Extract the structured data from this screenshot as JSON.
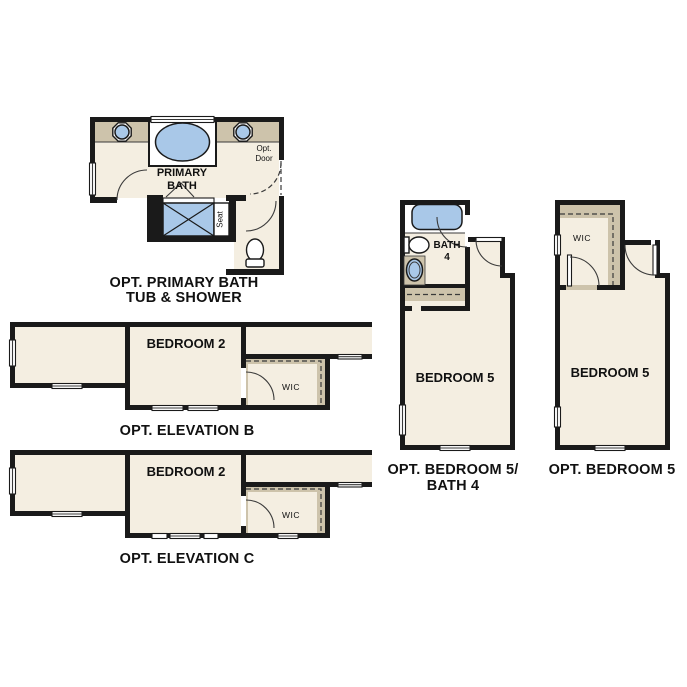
{
  "colors": {
    "wall": "#1a1a1a",
    "floor": "#f4eee1",
    "tan": "#cdc3ab",
    "blue": "#a9c8e8",
    "white": "#ffffff",
    "text": "#111111"
  },
  "plans": {
    "primary_bath": {
      "caption": [
        "OPT. PRIMARY BATH",
        "TUB & SHOWER"
      ],
      "room_label": [
        "PRIMARY",
        "BATH"
      ],
      "opt_door_label": [
        "Opt.",
        "Door"
      ],
      "seat_label": "Seat"
    },
    "elevation_b": {
      "caption": "OPT. ELEVATION B",
      "bedroom_label": "BEDROOM 2",
      "wic_label": "WIC"
    },
    "elevation_c": {
      "caption": "OPT. ELEVATION C",
      "bedroom_label": "BEDROOM 2",
      "wic_label": "WIC"
    },
    "bedroom5_bath4": {
      "caption": [
        "OPT. BEDROOM 5/",
        "BATH 4"
      ],
      "bath_label": [
        "BATH",
        "4"
      ],
      "bedroom_label": "BEDROOM 5"
    },
    "bedroom5": {
      "caption": "OPT. BEDROOM 5",
      "wic_label": "WIC",
      "bedroom_label": "BEDROOM 5"
    }
  }
}
